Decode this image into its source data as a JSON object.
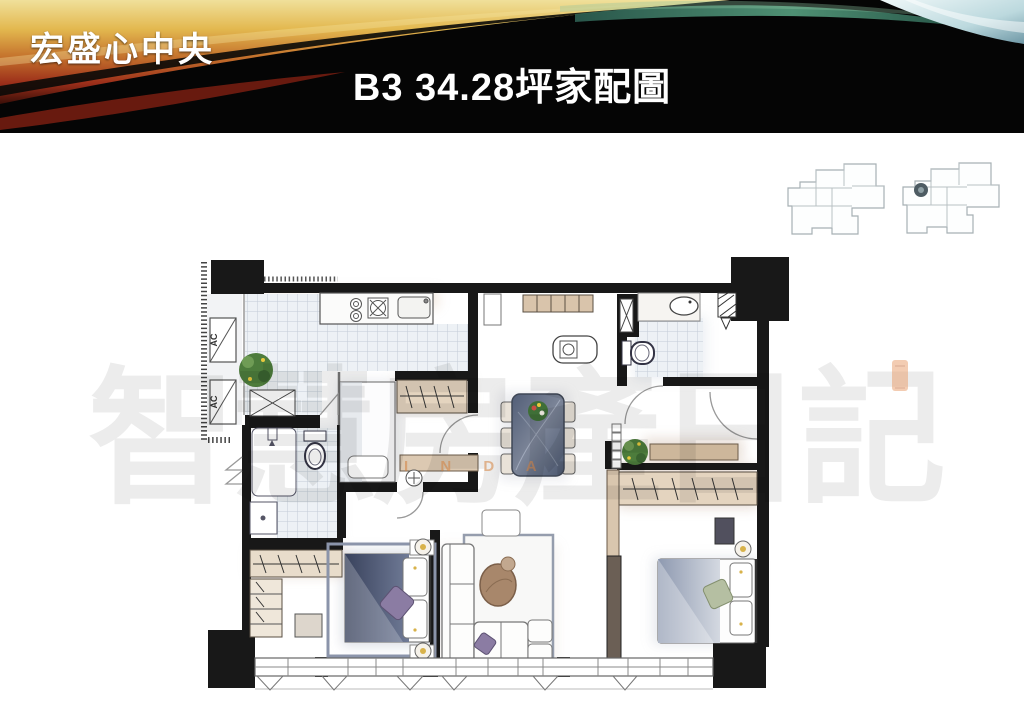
{
  "header": {
    "project_name": "宏盛心中央",
    "title": "B3 34.28坪家配圖"
  },
  "floor_plan": {
    "ac_unit_labels": [
      "AC",
      "AC"
    ]
  },
  "watermark": {
    "text": "智慧房產日記",
    "subtext": "I N D A"
  },
  "colors": {
    "banner_background": "#050505",
    "banner_gold": "#e3b84f",
    "banner_red": "#8e2b1a",
    "banner_teal": "#4f8f78",
    "banner_lightblue": "#bcd9de",
    "wall": "#181818",
    "tile": "#e9edf2",
    "wood": "#c3a284",
    "marble_table": "#5d6878",
    "bedding_dark": "#49536e",
    "bedding_light": "#9aa6bb",
    "accent_purple": "#8b7ca3",
    "plant_green": "#4d7c3c",
    "lamp_gold": "#d8b24a"
  }
}
